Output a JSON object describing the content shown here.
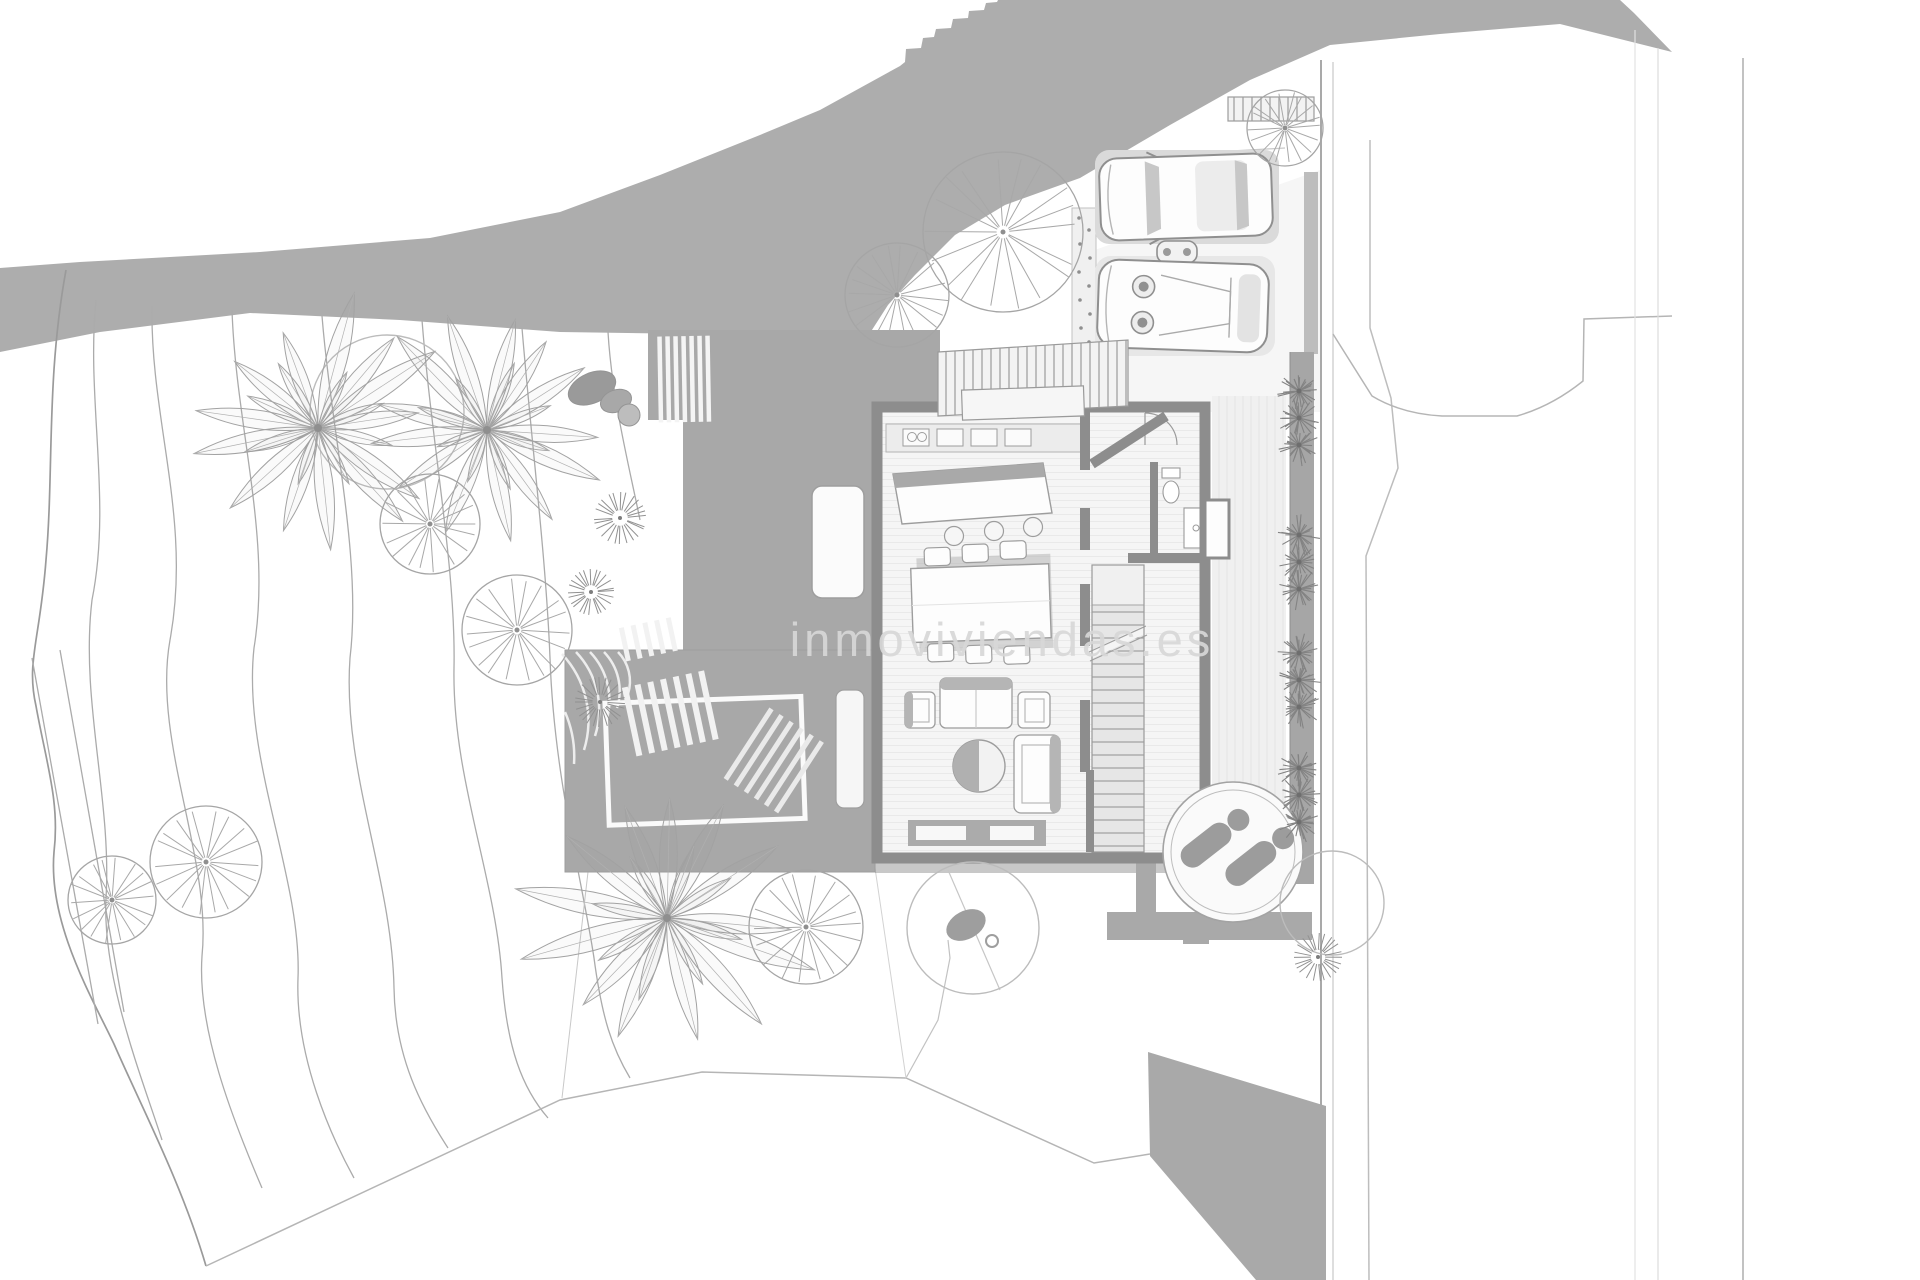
{
  "document": {
    "type": "architectural-site-plan",
    "floor": "ground-floor site plan of a hillside villa",
    "watermark": "inmoviviendas.es"
  },
  "canvas": {
    "width": 1920,
    "height": 1280,
    "background": "#ffffff"
  },
  "palette": {
    "hillside": "#adadad",
    "deck": "#a8a8a8",
    "walls": "#8d8d8d",
    "retaining_slope": "#a9a9a9",
    "floor": "#f5f5f5",
    "thin_lines": "#a5a5a5",
    "vegetation_lines": "#a2a2a2",
    "watermark_gray": "#d7d7d7"
  },
  "plan": {
    "palms": [
      {
        "x": 318,
        "y": 428,
        "r": 130
      },
      {
        "x": 487,
        "y": 430,
        "r": 122
      },
      {
        "x": 667,
        "y": 918,
        "r": 148
      }
    ],
    "wheel_trees": [
      {
        "x": 1003,
        "y": 232,
        "r": 80
      },
      {
        "x": 897,
        "y": 295,
        "r": 52
      },
      {
        "x": 430,
        "y": 524,
        "r": 50
      },
      {
        "x": 517,
        "y": 630,
        "r": 55
      },
      {
        "x": 206,
        "y": 862,
        "r": 56
      },
      {
        "x": 112,
        "y": 900,
        "r": 44
      },
      {
        "x": 806,
        "y": 927,
        "r": 57
      },
      {
        "x": 1285,
        "y": 128,
        "r": 38
      }
    ],
    "canopy_circles": [
      {
        "x": 387,
        "y": 412,
        "r": 77
      },
      {
        "x": 1332,
        "y": 903,
        "r": 52
      },
      {
        "x": 973,
        "y": 928,
        "r": 66
      }
    ],
    "sunburst_shrubs": [
      {
        "x": 620,
        "y": 518,
        "r": 26
      },
      {
        "x": 591,
        "y": 592,
        "r": 23
      },
      {
        "x": 600,
        "y": 702,
        "r": 25
      },
      {
        "x": 1318,
        "y": 957,
        "r": 24
      }
    ],
    "hedge_row": {
      "x": 1299,
      "y": [
        418,
        562,
        680,
        795
      ],
      "burst_r": 21
    },
    "boulders": [
      {
        "x": 592,
        "y": 388,
        "rx": 25,
        "ry": 15,
        "rot": -24
      },
      {
        "x": 616,
        "y": 401,
        "rx": 16,
        "ry": 11,
        "rot": -20
      },
      {
        "x": 629,
        "y": 415,
        "rx": 11,
        "ry": 11,
        "rot": 0
      }
    ]
  },
  "features": [
    {
      "id": "hillside",
      "label": "shaded hillside above the plot"
    },
    {
      "id": "contour-terraces",
      "label": "terraced garden contour lines"
    },
    {
      "id": "palm-trees",
      "label": "palm trees",
      "count": 3
    },
    {
      "id": "canopy-trees",
      "label": "round canopy trees",
      "count": 11
    },
    {
      "id": "shrubs",
      "label": "shrub sunbursts",
      "count": 4
    },
    {
      "id": "hedge-row",
      "label": "hedge bushes along garden wall",
      "count": 4
    },
    {
      "id": "driveway",
      "label": "driveway with parked cars",
      "count": 2
    },
    {
      "id": "scooter",
      "label": "scooter parked between cars",
      "count": 1
    },
    {
      "id": "entrance-stairs",
      "label": "external entrance staircase"
    },
    {
      "id": "timber-deck",
      "label": "timber deck terrace with stairs and railing"
    },
    {
      "id": "house",
      "label": "villa ground floor"
    },
    {
      "id": "kitchen",
      "label": "kitchen counter and island with 3 stools"
    },
    {
      "id": "dining",
      "label": "dining table with 6 chairs"
    },
    {
      "id": "living",
      "label": "living area: sofa, two armchairs, round table, chaise"
    },
    {
      "id": "interior-stairs",
      "label": "internal staircase"
    },
    {
      "id": "bathroom",
      "label": "guest bathroom"
    },
    {
      "id": "spa",
      "label": "circular spa deck with two loungers"
    },
    {
      "id": "retaining-slope",
      "label": "shaded retaining slope at the south-east corner"
    },
    {
      "id": "parcel-lines",
      "label": "adjacent road and parcel boundary lines"
    }
  ]
}
